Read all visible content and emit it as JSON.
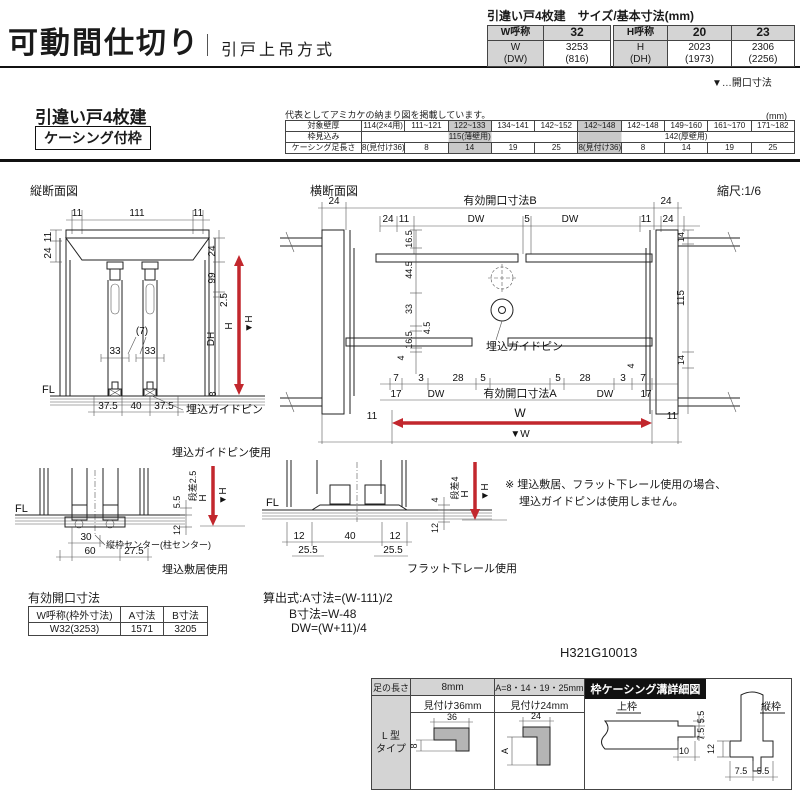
{
  "colors": {
    "accent_red": "#c2272d",
    "header_gray": "#d4d4d4",
    "shade_gray": "#c9c9c9"
  },
  "header": {
    "title": "可動間仕切り",
    "subtitle": "引戸上吊方式"
  },
  "size_spec": {
    "heading": "引違い戸4枚建　サイズ/基本寸法(mm)",
    "w_table": {
      "label": "W呼称",
      "name": "32",
      "sub1": "W",
      "sub2": "(DW)",
      "val1": "3253",
      "val2": "(816)"
    },
    "h_table": {
      "label": "H呼称",
      "name1": "20",
      "name2": "23",
      "sub1": "H",
      "sub2": "(DH)",
      "val1a": "2023",
      "val1b": "(1973)",
      "val2a": "2306",
      "val2b": "(2256)"
    },
    "legend": "▼…開口寸法"
  },
  "variant": {
    "title": "引違い戸4枚建",
    "frame_type": "ケーシング付枠",
    "note": "代表としてアミカケの納まり図を掲載しています。",
    "unit": "(mm)"
  },
  "wall_table": {
    "row1_label": "対象壁厚",
    "row1": [
      "114(2×4用)",
      "111~121",
      "122~133",
      "134~141",
      "142~152",
      "142~148",
      "142~148",
      "149~160",
      "161~170",
      "171~182"
    ],
    "row2_label": "枠見込み",
    "row2_thin": "115(薄壁用)",
    "row2_thick": "142(厚壁用)",
    "row3_label": "ケーシング足長さ",
    "row3": [
      "8(見付け36)",
      "8",
      "14",
      "19",
      "25",
      "8(見付け36)",
      "8",
      "14",
      "19",
      "25"
    ]
  },
  "vertical_section": {
    "title": "縦断面図",
    "top_dims": [
      "11",
      "111",
      "11"
    ],
    "left_dims": [
      "11",
      "24"
    ],
    "right_dims": [
      "24",
      "99",
      "2.5"
    ],
    "mid_dims": [
      "(7)",
      "33",
      "33"
    ],
    "height_dims": {
      "dh": "DH",
      "h": "H",
      "h_mark": "▼H",
      "bottom": "8"
    },
    "fl": "FL",
    "bottom_dims": [
      "37.5",
      "40",
      "37.5"
    ],
    "pin_label": "埋込ガイドピン"
  },
  "horizontal_section": {
    "title": "横断面図",
    "scale": "縮尺:1/6",
    "top_label": "有効開口寸法B",
    "top_left": "24",
    "top_right": "24",
    "row2": [
      "24",
      "11",
      "DW",
      "5",
      "DW",
      "11",
      "24"
    ],
    "right_top": "14",
    "right_mid": "115",
    "right_low": "4",
    "right_bottom": "14",
    "left_low": "4",
    "left_chain": [
      "16.5",
      "44.5",
      "33",
      "4.5",
      "16.5"
    ],
    "pin_label": "埋込ガイドピン",
    "bottom_chain": [
      "7",
      "3",
      "28",
      "5",
      "5",
      "28",
      "3",
      "7"
    ],
    "bottom_row2": [
      "17",
      "DW",
      "有効開口寸法A",
      "DW",
      "17"
    ],
    "w_left": "11",
    "w_label": "W",
    "w_right": "11",
    "w_mark": "▼W"
  },
  "detail_sill": {
    "title": "埋込ガイドピン使用",
    "caption": "埋込敷居使用",
    "fl": "FL",
    "step": "段差2.5",
    "d55": "5.5",
    "d12": "12",
    "d30": "30",
    "d60": "60",
    "d275": "27.5",
    "center": "縦枠センター(柱センター)",
    "h": "H",
    "h_mark": "▼H"
  },
  "detail_rail": {
    "caption": "フラット下レール使用",
    "fl": "FL",
    "step": "段差4",
    "d4": "4",
    "d12side": "12",
    "d12a": "12",
    "d40": "40",
    "d12b": "12",
    "d255a": "25.5",
    "d255b": "25.5",
    "h": "H",
    "h_mark": "▼H"
  },
  "note": {
    "line1": "※ 埋込敷居、フラット下レール使用の場合、",
    "line2": "埋込ガイドピンは使用しません。"
  },
  "opening_table": {
    "title": "有効開口寸法",
    "headers": [
      "W呼称(枠外寸法)",
      "A寸法",
      "B寸法"
    ],
    "row": [
      "W32(3253)",
      "1571",
      "3205"
    ]
  },
  "formulas": {
    "line1": "算出式:A寸法=(W-111)/2",
    "line2": "B寸法=W-48",
    "line3": "DW=(W+11)/4"
  },
  "drawing_number": "H321G10013",
  "leg_table": {
    "corner": "足の長さ",
    "col1_head": "8mm",
    "col2_head": "A=8・14・19・25mm",
    "detail_head": "枠ケーシング溝詳細図",
    "col1_sub": "見付け36mm",
    "col2_sub": "見付け24mm",
    "type_line1": "L 型",
    "type_line2": "タイプ",
    "l1_w": "36",
    "l1_leg": "8",
    "l2_w": "24",
    "l2_leg": "A",
    "top_frame": "上枠",
    "top_dims": [
      "5.5",
      "7.5",
      "10"
    ],
    "side_frame": "縦枠",
    "side_dims": [
      "12",
      "7.5",
      "5.5"
    ]
  }
}
